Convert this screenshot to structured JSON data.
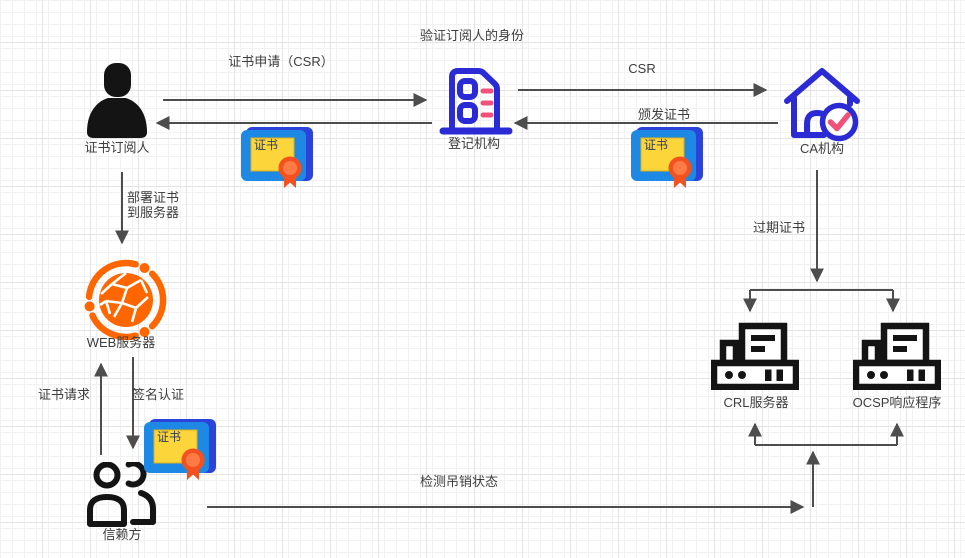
{
  "diagram": {
    "nodes": {
      "subscriber": "证书订阅人",
      "registration_authority": "登记机构",
      "ca": "CA机构",
      "web_server": "WEB服务器",
      "relying_party": "信赖方",
      "crl_server": "CRL服务器",
      "ocsp_responder": "OCSP响应程序"
    },
    "labels": {
      "verify_identity": "验证订阅人的身份",
      "cert_apply_csr": "证书申请（CSR）",
      "csr": "CSR",
      "issue_cert": "颁发证书",
      "deploy_cert_line1": "部署证书",
      "deploy_cert_line2": "到服务器",
      "expired_cert": "过期证书",
      "cert_request": "证书请求",
      "signature_auth": "签名认证",
      "check_revocation_status": "检测吊销状态"
    },
    "certificate_badge": "证书",
    "colors": {
      "arrow": "#4d4d4d",
      "outline_blue": "#2b2bd5",
      "accent_pink": "#f0517b",
      "cert_back_blue": "#2b43d8",
      "cert_front_blue": "#1e88e5",
      "cert_yellow": "#fcd53a",
      "cert_seal_orange": "#f4511e",
      "web_orange": "#ff6600",
      "icon_black": "#141414"
    }
  }
}
